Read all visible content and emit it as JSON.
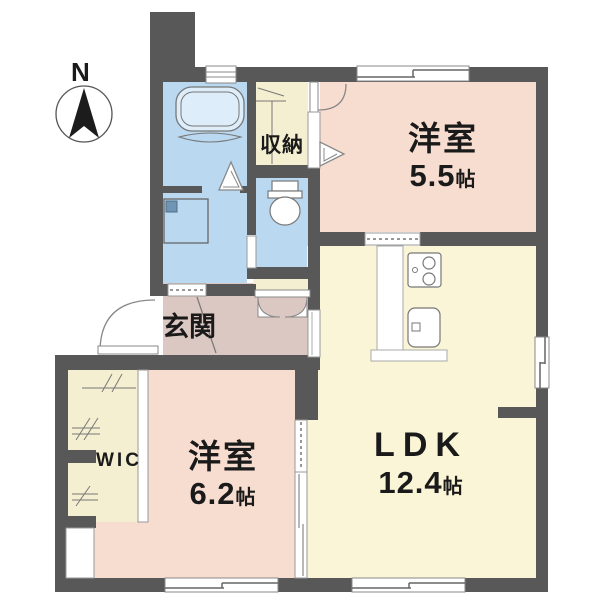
{
  "compass": {
    "label": "N"
  },
  "rooms": {
    "bedroom1": {
      "name": "洋室",
      "size_value": "5.5",
      "size_unit": "帖"
    },
    "ldk": {
      "name": "LDK",
      "size_value": "12.4",
      "size_unit": "帖"
    },
    "bedroom2": {
      "name": "洋室",
      "size_value": "6.2",
      "size_unit": "帖"
    },
    "entrance": {
      "name": "玄関"
    },
    "storage": {
      "name": "収納"
    },
    "wic": {
      "name": "WIC"
    }
  },
  "colors": {
    "wall": "#585858",
    "bedroom_fill": "#f7dcd0",
    "ldk_fill": "#f9f5d6",
    "wet_fill": "#bad9f1",
    "entrance_fill": "#dcc8c3",
    "storage_fill": "#f5efd1",
    "line": "#888888",
    "text": "#1a1a1a"
  }
}
